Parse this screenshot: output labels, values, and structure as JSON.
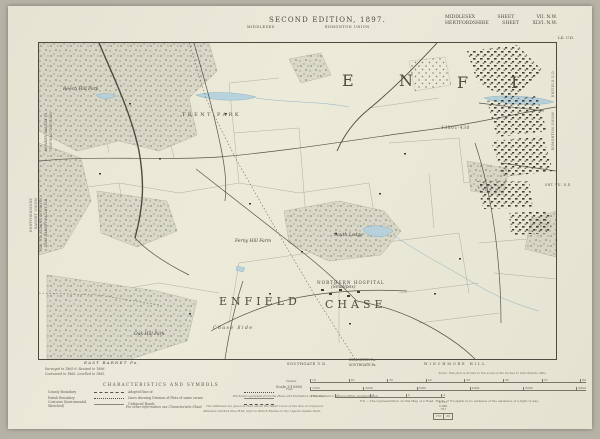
{
  "header": {
    "title": "SECOND EDITION, 1897.",
    "subtitle_left": "MIDDLESEX",
    "subtitle_right": "EDMONTON UNION",
    "sheet_ref": [
      {
        "county": "MIDDLESEX",
        "label": "SHEET",
        "number": "VII. N.W."
      },
      {
        "county": "HERTFORDSHIRE",
        "label": "SHEET",
        "number": "XLVI. N.W."
      }
    ],
    "corner_note": "LD. U.D."
  },
  "map": {
    "large_letters": [
      {
        "t": "E",
        "x": 303,
        "y": 28
      },
      {
        "t": "N",
        "x": 360,
        "y": 28
      },
      {
        "t": "F",
        "x": 418,
        "y": 30
      },
      {
        "t": "I",
        "x": 472,
        "y": 30
      }
    ],
    "labels": [
      {
        "t": "ENFIELD",
        "x": 180,
        "y": 252,
        "cls": "big2"
      },
      {
        "t": "CHASE",
        "x": 286,
        "y": 255,
        "cls": "big2"
      },
      {
        "t": "TRENT PARK",
        "x": 143,
        "y": 69,
        "cls": "park"
      },
      {
        "t": "NORTHERN HOSPITAL",
        "x": 278,
        "y": 237,
        "cls": "tiny-caps"
      },
      {
        "t": "(Smallpox)",
        "x": 292,
        "y": 242,
        "cls": "tiny-ital"
      },
      {
        "t": "South Lodge",
        "x": 295,
        "y": 190,
        "cls": "tiny-ital"
      },
      {
        "t": "Chase Side",
        "x": 174,
        "y": 283,
        "cls": "tiny-ital sp"
      },
      {
        "t": "Oak Hill Park",
        "x": 95,
        "y": 289,
        "cls": "tiny-ital"
      },
      {
        "t": "Beech Hill Park",
        "x": 24,
        "y": 44,
        "cls": "tiny-ital"
      },
      {
        "t": "Ferny Hill Farm",
        "x": 196,
        "y": 196,
        "cls": "tiny-ital"
      },
      {
        "t": "13801·430",
        "x": 402,
        "y": 83,
        "cls": "tiny-num"
      }
    ]
  },
  "margins": {
    "left_sheet_ref_1": "SHT. VI. N.E.",
    "left_sheet_ref_2": "SHEET XLV. N.E.",
    "overlay": [
      {
        "t": "ENFIELD DIVISION",
        "x": 41,
        "y": 106,
        "cls": "m-tiny vert",
        "name": "left-margin-division-label"
      },
      {
        "t": "MONKEN HADLEY Pa.",
        "x": 36,
        "y": 106,
        "cls": "m-ital vert",
        "name": "left-margin-parish-label"
      },
      {
        "t": "HERTFORDSHIRE",
        "x": 21,
        "y": 192,
        "cls": "m-tiny vert",
        "name": "left-margin-county-label"
      },
      {
        "t": "BARNET UNION",
        "x": 26,
        "y": 192,
        "cls": "m-tiny vert",
        "name": "left-margin-union-label"
      },
      {
        "t": "MID. ST. ALBANS DIVISION",
        "x": 31,
        "y": 192,
        "cls": "m-tiny vert",
        "name": "left-margin-division2-label"
      },
      {
        "t": "EAST BARNET VALLEY U.D.",
        "x": 36,
        "y": 192,
        "cls": "m-ital vert",
        "name": "left-margin-district-label"
      },
      {
        "t": "ENFIELD U.D.",
        "x": 543,
        "y": 64,
        "cls": "m-tiny vert",
        "name": "right-margin-district-label"
      },
      {
        "t": "EDMONTON UNION",
        "x": 543,
        "y": 106,
        "cls": "m-tiny vert",
        "name": "right-margin-union-label"
      },
      {
        "t": "SHT. VII. N.E.",
        "x": 537,
        "y": 177,
        "cls": "m-tiny",
        "name": "right-margin-sheet-label"
      }
    ]
  },
  "footer": {
    "survey_note1": "Surveyed in 1865-6. Revised in 1896.",
    "survey_note2": "Contoured in 1866. Levelled in 1865.",
    "east_barnet": "EAST BARNET Pa.",
    "southgate_ud": "SOUTHGATE U.D.",
    "edmonton_pa": "EDMONTON Pa.",
    "southgate_pa": "SOUTHGATE Pa.",
    "winchmore": "WINCHMORE HILL",
    "legend_title": "CHARACTERISTICS AND SYMBOLS",
    "legend_rows": [
      {
        "label": "County Boundary",
        "mid": "Adopted line of"
      },
      {
        "label": "Parish Boundary",
        "mid": "Lines showing Division of Plots of same owner"
      },
      {
        "label": "Contours (Instrumental, Sketched)",
        "mid": "Unfenced Roads"
      }
    ],
    "legend_note": "For other information see Characteristic Sheet",
    "scale_note": "Scale: this plan is drawn to the scale of Six Inches to One Statute Mile",
    "scale_label": "Scale 1/10560",
    "rulers": [
      {
        "unit": "Chains",
        "ticks": [
          "10",
          "20",
          "30",
          "40",
          "50",
          "60",
          "70",
          "80"
        ],
        "x": 302,
        "y": 373,
        "w": 276
      },
      {
        "unit": "Feet",
        "ticks": [
          "1000",
          "2000",
          "3000",
          "4000",
          "5000",
          "6000"
        ],
        "x": 302,
        "y": 381,
        "w": 276
      },
      {
        "unit": "Furlongs",
        "ticks": [
          "1",
          "2",
          "3",
          "4"
        ],
        "x": 327,
        "y": 388,
        "w": 110
      }
    ],
    "publish_note": "Photozincographed from the Plans and Published at the Ordnance Survey Office, Southampton.",
    "fp_note": "F.P. — The representation on this Map of a Road, Track, or Footpath, is no evidence of the existence of a right of way.",
    "alt_note1": "The Altitudes are given in Feet above the Mean Level of the Sea at Liverpool.",
    "alt_note2": "Altitudes marked thus B.M. refer to Bench Marks on the objects beside them.",
    "bm_figures": [
      "4·721",
      "3·960",
      "·761"
    ],
    "bm_box": [
      "178",
      "·36"
    ]
  }
}
